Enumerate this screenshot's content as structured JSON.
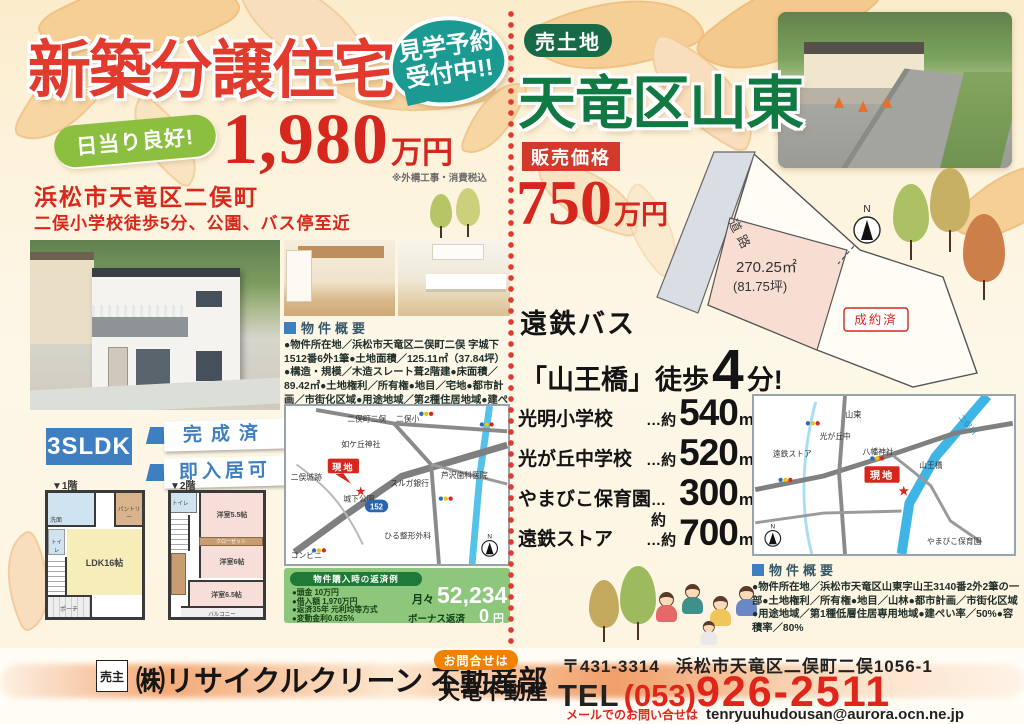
{
  "left": {
    "headline": "新築分譲住宅",
    "tour_badge_line1": "見学予約",
    "tour_badge_line2": "受付中!!",
    "sun_pill": "日当り良好!",
    "price": "1,980",
    "price_unit": "万円",
    "price_note": "※外構工事・消費税込",
    "address": "浜松市天竜区二俣町",
    "address_sub": "二俣小学校徒歩5分、公園、バス停至近",
    "layout": "3SLDK",
    "status1": "完成済",
    "status2": "即入居可",
    "fp1_label": "▼1階",
    "fp2_label": "▼2階",
    "fp1": {
      "ldk": "LDK16帖",
      "pantry": "パントリー",
      "toilet": "トイレ",
      "wash": "洗面",
      "porch": "ポーチ"
    },
    "fp2": {
      "r1": "洋室5.5帖",
      "r2": "洋室6帖",
      "r3": "洋室6.5帖",
      "closet": "クローゼット",
      "balcony": "バルコニー",
      "toilet": "トイレ"
    },
    "overview_title": "物件概要",
    "overview_body": "●物件所在地／浜松市天竜区二俣町二俣 字城下1512番6外1筆●土地面積／125.11㎡（37.84坪）●構造・規模／木造スレート葺2階建●床面積／89.42㎡●土地権利／所有権●地目／宅地●都市計画／市街化区域●用途地域／第2種住居地域●建ぺい率／70%●容積率／160%●築年月／平成29年5月●現況／完成済",
    "map": {
      "area": "二俣町二俣",
      "school": "二俣小",
      "shrine": "如ケ丘神社",
      "site": "現地",
      "castle": "二俣城跡",
      "park": "城下公園",
      "bank": "スルガ銀行",
      "dental": "芦沢歯科医院",
      "clinic": "ひる整形外科",
      "conv": "コンビニ",
      "route": "152",
      "north": "N",
      "star": "★"
    },
    "payment": {
      "title": "物件購入時の返済例",
      "item1": "●頭金 10万円",
      "item2": "●借入額 1,970万円",
      "item3": "●返済35年 元利均等方式",
      "item4": "●変動金利0.625%",
      "monthly_label": "月々",
      "monthly_value": "52,234",
      "monthly_unit": "円",
      "bonus_label": "ボーナス返済",
      "bonus_value": "0",
      "bonus_unit": "円"
    }
  },
  "right": {
    "badge": "売土地",
    "headline": "天竜区山東",
    "price_label": "販売価格",
    "price": "750",
    "price_unit": "万円",
    "lot": {
      "road": "道路",
      "area": "270.25㎡",
      "tsubo": "(81.75坪)",
      "sold": "成約済",
      "north": "N"
    },
    "bus_line1": "遠鉄バス",
    "bus_pre": "「山王橋」徒歩",
    "bus_min": "4",
    "bus_suffix": "分!",
    "distances": [
      {
        "name": "光明小学校",
        "approx": "…約",
        "value": "540",
        "unit": "m"
      },
      {
        "name": "光が丘中学校",
        "approx": "…約",
        "value": "520",
        "unit": "m"
      },
      {
        "name": "やまびこ保育園",
        "approx": "…約",
        "value": "300",
        "unit": "m"
      },
      {
        "name": "遠鉄ストア",
        "approx": "…約",
        "value": "700",
        "unit": "m"
      }
    ],
    "map": {
      "area": "山東",
      "school": "光が丘中",
      "store": "遠鉄ストア",
      "shrine": "八幡神社",
      "river": "二俣川",
      "site": "現地",
      "bridge": "山王橋",
      "nursery": "やまびこ保育園",
      "north": "N",
      "star": "★"
    },
    "overview_title": "物件概要",
    "overview_body": "●物件所在地／浜松市天竜区山東字山王3140番2外2筆の一部●土地権利／所有権●地目／山林●都市計画／市街化区域●用途地域／第1種低層住居専用地域●建ぺい率／50%●容積率／80%"
  },
  "footer": {
    "seller_label": "売主",
    "company": "㈱リサイクルクリーン 不動産部",
    "contact_badge": "お問合せは",
    "agency": "天竜不動産",
    "postal": "〒431-3314",
    "address": "浜松市天竜区二俣町二俣1056-1",
    "tel_label": "TEL",
    "tel_area": "(053)",
    "tel_number": "926-2511",
    "mail_label": "メールでのお問い合せは",
    "email": "tenryuuhudousan@aurora.ocn.ne.jp"
  },
  "colors": {
    "accent_red": "#d5271d",
    "teal": "#1a9a90",
    "green_pill": "#8cbf40",
    "blue": "#3d7fc1",
    "dark_green": "#176a45",
    "payment_green": "#8cc77c",
    "orange": "#ef8200"
  }
}
